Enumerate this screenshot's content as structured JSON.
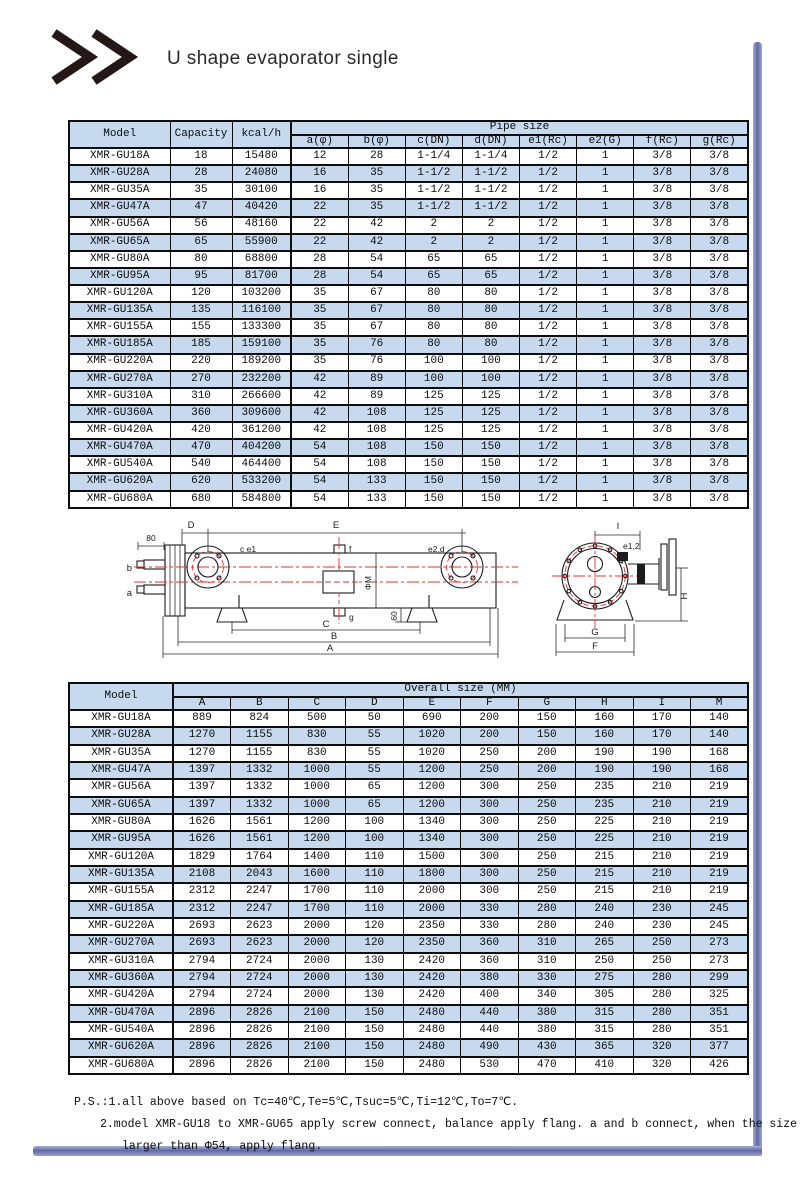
{
  "page": {
    "title": "U shape evaporator single"
  },
  "pipe_table": {
    "model_header": "Model",
    "capacity_header": "Capacity",
    "kcal_header": "kcal/h",
    "group_header": "Pipe size",
    "sub_headers": [
      "a(φ)",
      "b(φ)",
      "c(DN)",
      "d(DN)",
      "e1(Rc)",
      "e2(G)",
      "f(Rc)",
      "g(Rc)"
    ],
    "rows": [
      [
        "XMR-GU18A",
        "18",
        "15480",
        "12",
        "28",
        "1-1/4",
        "1-1/4",
        "1/2",
        "1",
        "3/8",
        "3/8"
      ],
      [
        "XMR-GU28A",
        "28",
        "24080",
        "16",
        "35",
        "1-1/2",
        "1-1/2",
        "1/2",
        "1",
        "3/8",
        "3/8"
      ],
      [
        "XMR-GU35A",
        "35",
        "30100",
        "16",
        "35",
        "1-1/2",
        "1-1/2",
        "1/2",
        "1",
        "3/8",
        "3/8"
      ],
      [
        "XMR-GU47A",
        "47",
        "40420",
        "22",
        "35",
        "1-1/2",
        "1-1/2",
        "1/2",
        "1",
        "3/8",
        "3/8"
      ],
      [
        "XMR-GU56A",
        "56",
        "48160",
        "22",
        "42",
        "2",
        "2",
        "1/2",
        "1",
        "3/8",
        "3/8"
      ],
      [
        "XMR-GU65A",
        "65",
        "55900",
        "22",
        "42",
        "2",
        "2",
        "1/2",
        "1",
        "3/8",
        "3/8"
      ],
      [
        "XMR-GU80A",
        "80",
        "68800",
        "28",
        "54",
        "65",
        "65",
        "1/2",
        "1",
        "3/8",
        "3/8"
      ],
      [
        "XMR-GU95A",
        "95",
        "81700",
        "28",
        "54",
        "65",
        "65",
        "1/2",
        "1",
        "3/8",
        "3/8"
      ],
      [
        "XMR-GU120A",
        "120",
        "103200",
        "35",
        "67",
        "80",
        "80",
        "1/2",
        "1",
        "3/8",
        "3/8"
      ],
      [
        "XMR-GU135A",
        "135",
        "116100",
        "35",
        "67",
        "80",
        "80",
        "1/2",
        "1",
        "3/8",
        "3/8"
      ],
      [
        "XMR-GU155A",
        "155",
        "133300",
        "35",
        "67",
        "80",
        "80",
        "1/2",
        "1",
        "3/8",
        "3/8"
      ],
      [
        "XMR-GU185A",
        "185",
        "159100",
        "35",
        "76",
        "80",
        "80",
        "1/2",
        "1",
        "3/8",
        "3/8"
      ],
      [
        "XMR-GU220A",
        "220",
        "189200",
        "35",
        "76",
        "100",
        "100",
        "1/2",
        "1",
        "3/8",
        "3/8"
      ],
      [
        "XMR-GU270A",
        "270",
        "232200",
        "42",
        "89",
        "100",
        "100",
        "1/2",
        "1",
        "3/8",
        "3/8"
      ],
      [
        "XMR-GU310A",
        "310",
        "266600",
        "42",
        "89",
        "125",
        "125",
        "1/2",
        "1",
        "3/8",
        "3/8"
      ],
      [
        "XMR-GU360A",
        "360",
        "309600",
        "42",
        "108",
        "125",
        "125",
        "1/2",
        "1",
        "3/8",
        "3/8"
      ],
      [
        "XMR-GU420A",
        "420",
        "361200",
        "42",
        "108",
        "125",
        "125",
        "1/2",
        "1",
        "3/8",
        "3/8"
      ],
      [
        "XMR-GU470A",
        "470",
        "404200",
        "54",
        "108",
        "150",
        "150",
        "1/2",
        "1",
        "3/8",
        "3/8"
      ],
      [
        "XMR-GU540A",
        "540",
        "464400",
        "54",
        "108",
        "150",
        "150",
        "1/2",
        "1",
        "3/8",
        "3/8"
      ],
      [
        "XMR-GU620A",
        "620",
        "533200",
        "54",
        "133",
        "150",
        "150",
        "1/2",
        "1",
        "3/8",
        "3/8"
      ],
      [
        "XMR-GU680A",
        "680",
        "584800",
        "54",
        "133",
        "150",
        "150",
        "1/2",
        "1",
        "3/8",
        "3/8"
      ]
    ]
  },
  "diagram": {
    "labels": {
      "d80": "80",
      "b": "b",
      "a": "a",
      "ce1": "c e1",
      "f": "f",
      "e2d": "e2,d",
      "phiM": "ΦM",
      "g": "g",
      "n60": "60",
      "D": "D",
      "E": "E",
      "C": "C",
      "B": "B",
      "A": "A",
      "I": "I",
      "e12": "e1,2",
      "H": "H",
      "G": "G",
      "F": "F"
    }
  },
  "overall_table": {
    "model_header": "Model",
    "group_header": "Overall size (MM)",
    "sub_headers": [
      "A",
      "B",
      "C",
      "D",
      "E",
      "F",
      "G",
      "H",
      "I",
      "M"
    ],
    "rows": [
      [
        "XMR-GU18A",
        "889",
        "824",
        "500",
        "50",
        "690",
        "200",
        "150",
        "160",
        "170",
        "140"
      ],
      [
        "XMR-GU28A",
        "1270",
        "1155",
        "830",
        "55",
        "1020",
        "200",
        "150",
        "160",
        "170",
        "140"
      ],
      [
        "XMR-GU35A",
        "1270",
        "1155",
        "830",
        "55",
        "1020",
        "250",
        "200",
        "190",
        "190",
        "168"
      ],
      [
        "XMR-GU47A",
        "1397",
        "1332",
        "1000",
        "55",
        "1200",
        "250",
        "200",
        "190",
        "190",
        "168"
      ],
      [
        "XMR-GU56A",
        "1397",
        "1332",
        "1000",
        "65",
        "1200",
        "300",
        "250",
        "235",
        "210",
        "219"
      ],
      [
        "XMR-GU65A",
        "1397",
        "1332",
        "1000",
        "65",
        "1200",
        "300",
        "250",
        "235",
        "210",
        "219"
      ],
      [
        "XMR-GU80A",
        "1626",
        "1561",
        "1200",
        "100",
        "1340",
        "300",
        "250",
        "225",
        "210",
        "219"
      ],
      [
        "XMR-GU95A",
        "1626",
        "1561",
        "1200",
        "100",
        "1340",
        "300",
        "250",
        "225",
        "210",
        "219"
      ],
      [
        "XMR-GU120A",
        "1829",
        "1764",
        "1400",
        "110",
        "1500",
        "300",
        "250",
        "215",
        "210",
        "219"
      ],
      [
        "XMR-GU135A",
        "2108",
        "2043",
        "1600",
        "110",
        "1800",
        "300",
        "250",
        "215",
        "210",
        "219"
      ],
      [
        "XMR-GU155A",
        "2312",
        "2247",
        "1700",
        "110",
        "2000",
        "300",
        "250",
        "215",
        "210",
        "219"
      ],
      [
        "XMR-GU185A",
        "2312",
        "2247",
        "1700",
        "110",
        "2000",
        "330",
        "280",
        "240",
        "230",
        "245"
      ],
      [
        "XMR-GU220A",
        "2693",
        "2623",
        "2000",
        "120",
        "2350",
        "330",
        "280",
        "240",
        "230",
        "245"
      ],
      [
        "XMR-GU270A",
        "2693",
        "2623",
        "2000",
        "120",
        "2350",
        "360",
        "310",
        "265",
        "250",
        "273"
      ],
      [
        "XMR-GU310A",
        "2794",
        "2724",
        "2000",
        "130",
        "2420",
        "360",
        "310",
        "250",
        "250",
        "273"
      ],
      [
        "XMR-GU360A",
        "2794",
        "2724",
        "2000",
        "130",
        "2420",
        "380",
        "330",
        "275",
        "280",
        "299"
      ],
      [
        "XMR-GU420A",
        "2794",
        "2724",
        "2000",
        "130",
        "2420",
        "400",
        "340",
        "305",
        "280",
        "325"
      ],
      [
        "XMR-GU470A",
        "2896",
        "2826",
        "2100",
        "150",
        "2480",
        "440",
        "380",
        "315",
        "280",
        "351"
      ],
      [
        "XMR-GU540A",
        "2896",
        "2826",
        "2100",
        "150",
        "2480",
        "440",
        "380",
        "315",
        "280",
        "351"
      ],
      [
        "XMR-GU620A",
        "2896",
        "2826",
        "2100",
        "150",
        "2480",
        "490",
        "430",
        "365",
        "320",
        "377"
      ],
      [
        "XMR-GU680A",
        "2896",
        "2826",
        "2100",
        "150",
        "2480",
        "530",
        "470",
        "410",
        "320",
        "426"
      ]
    ]
  },
  "notes": {
    "line1": "P.S.:1.all above based on Tc=40℃,Te=5℃,Tsuc=5℃,Ti=12℃,To=7℃.",
    "line2": "2.model XMR-GU18 to XMR-GU65 apply screw connect, balance apply flang. a and b connect, when the size is",
    "line3": "larger than Φ54, apply flang."
  },
  "colors": {
    "table_blue": "#c6d9ee",
    "frame_light": "#aab1d6",
    "frame_mid": "#5f69a6",
    "diagram_red": "#e0332c",
    "ink": "#111111"
  }
}
